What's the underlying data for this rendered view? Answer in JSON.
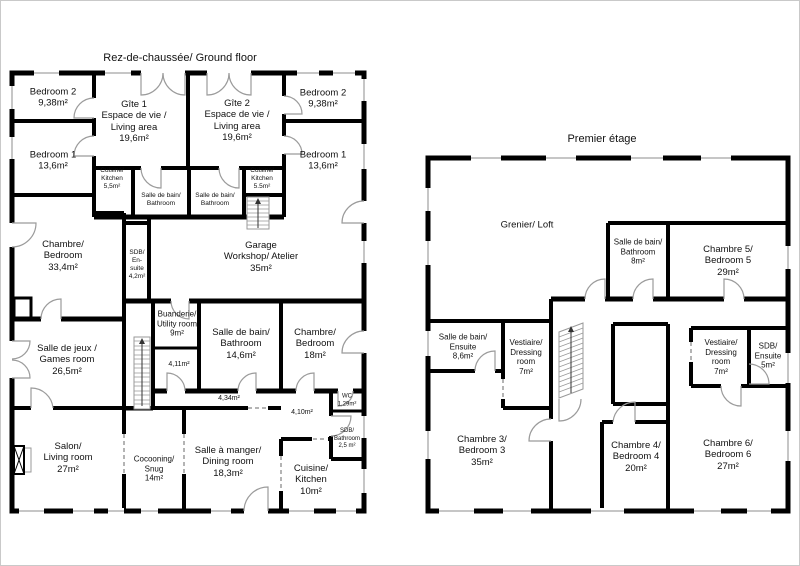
{
  "colors": {
    "walls": "#000000",
    "background": "#ffffff",
    "door_arc": "#9b9b9b",
    "window": "#b4b4b4"
  },
  "ground_floor": {
    "title": "Rez-de-chaussée/ Ground floor",
    "rooms": {
      "bedroom2_left": "Bedroom 2\n9,38m²",
      "bedroom1_left": "Bedroom 1\n13,6m²",
      "gite1": "Gîte 1\nEspace de vie /\nLiving area\n19,6m²",
      "gite2": "Gîte 2\nEspace de vie /\nLiving area\n19,6m²",
      "bedroom2_right": "Bedroom 2\n9,38m²",
      "bedroom1_right": "Bedroom 1\n13,6m²",
      "kitchen_left": "Cuisine/\nKitchen\n5,5m²",
      "bathroom_mid_left": "Salle de bain/\nBathroom",
      "bathroom_mid_right": "Salle de bain/\nBathroom",
      "kitchen_right": "Cuisine/\nKitchen\n5.5m²",
      "master_bedroom": "Chambre/\nBedroom\n33,4m²",
      "sdb_ensuite": "SDB/\nEn-\nsuite\n4,2m²",
      "garage": "Garage\nWorkshop/ Atelier\n35m²",
      "games_room": "Salle de jeux /\nGames room\n26,5m²",
      "utility_room": "Buanderie/\nUtility room\n9m²",
      "hall_411": "4,11m²",
      "bathroom_146": "Salle de bain/\nBathroom\n14,6m²",
      "bedroom_18": "Chambre/\nBedroom\n18m²",
      "hall_434": "4,34m²",
      "hall_410": "4,10m²",
      "wc": "WC\n1,29m²",
      "sdb_25": "SDB/\nBathroom\n2,5 m²",
      "living_room": "Salon/\nLiving room\n27m²",
      "snug": "Cocooning/\nSnug\n14m²",
      "dining_room": "Salle à manger/\nDining room\n18,3m²",
      "kitchen_10": "Cuisine/\nKitchen\n10m²"
    }
  },
  "first_floor": {
    "title": "Premier étage",
    "rooms": {
      "loft": "Grenier/ Loft",
      "bathroom_8": "Salle de bain/\nBathroom\n8m²",
      "bedroom5": "Chambre 5/ Bedroom 5\n29m²",
      "ensuite_86": "Salle de bain/\nEnsuite\n8,6m²",
      "dressing_left": "Vestiaire/\nDressing\nroom\n7m²",
      "dressing_right": "Vestiaire/\nDressing\nroom\n7m²",
      "sdb_ensuite_5": "SDB/\nEnsuite\n5m²",
      "bedroom3": "Chambre 3/\nBedroom 3\n35m²",
      "bedroom4": "Chambre 4/\nBedroom 4\n20m²",
      "bedroom6": "Chambre 6/\nBedroom 6\n27m²"
    }
  }
}
